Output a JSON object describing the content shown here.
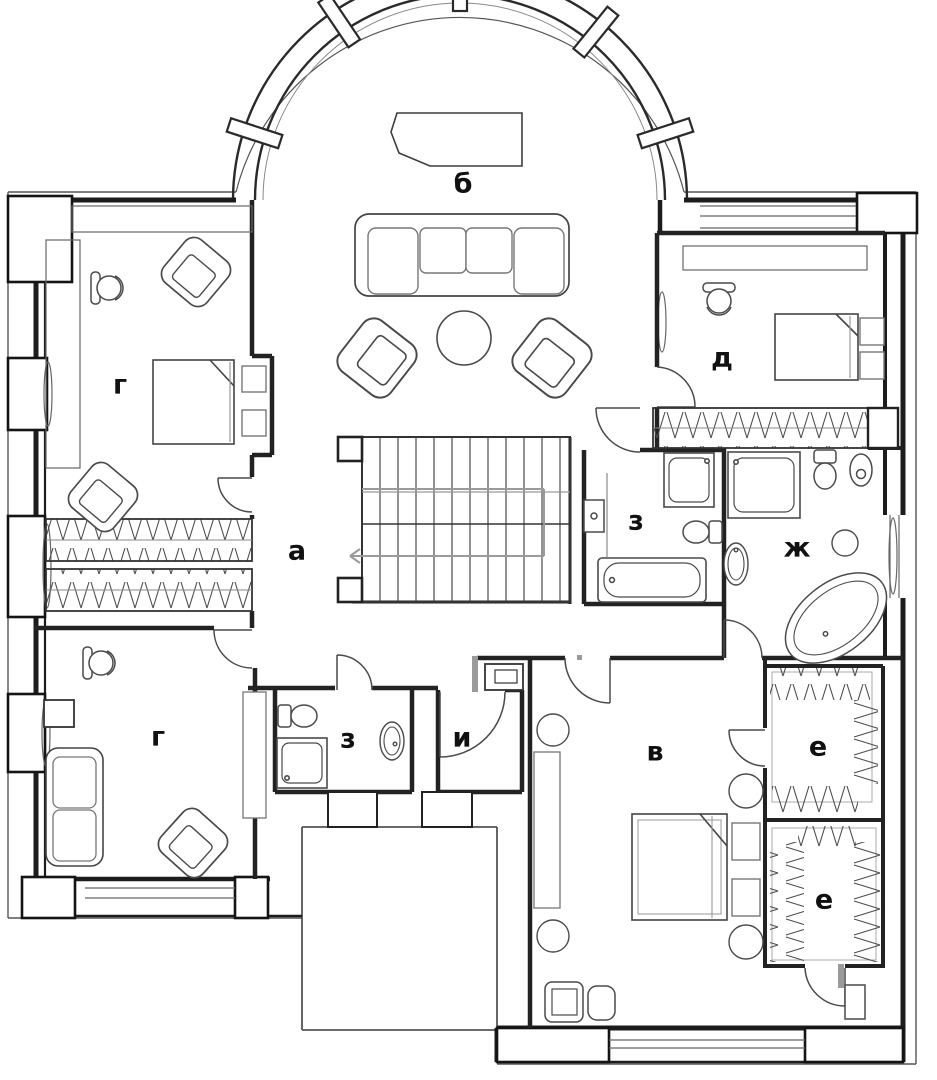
{
  "plan": {
    "type": "floor-plan",
    "floor_note": "",
    "rooms": [
      {
        "id": "living-room",
        "label": "б"
      },
      {
        "id": "bedroom-top-left",
        "label": "г"
      },
      {
        "id": "hallway",
        "label": "а"
      },
      {
        "id": "bedroom-top-right",
        "label": "д"
      },
      {
        "id": "bathroom-center",
        "label": "з"
      },
      {
        "id": "bathroom-right",
        "label": "ж"
      },
      {
        "id": "bedroom-bottom-left",
        "label": "г"
      },
      {
        "id": "bathroom-bottom",
        "label": "з"
      },
      {
        "id": "utility-room",
        "label": "и"
      },
      {
        "id": "bedroom-bottom-right",
        "label": "в"
      },
      {
        "id": "closet-top",
        "label": "е"
      },
      {
        "id": "closet-bottom",
        "label": "е"
      }
    ],
    "palette": {
      "background": "#ffffff",
      "wall": "#1c1c1c",
      "furniture": "#4a4a4a",
      "light_gray": "#9a9a9a",
      "label": "#111111"
    }
  }
}
